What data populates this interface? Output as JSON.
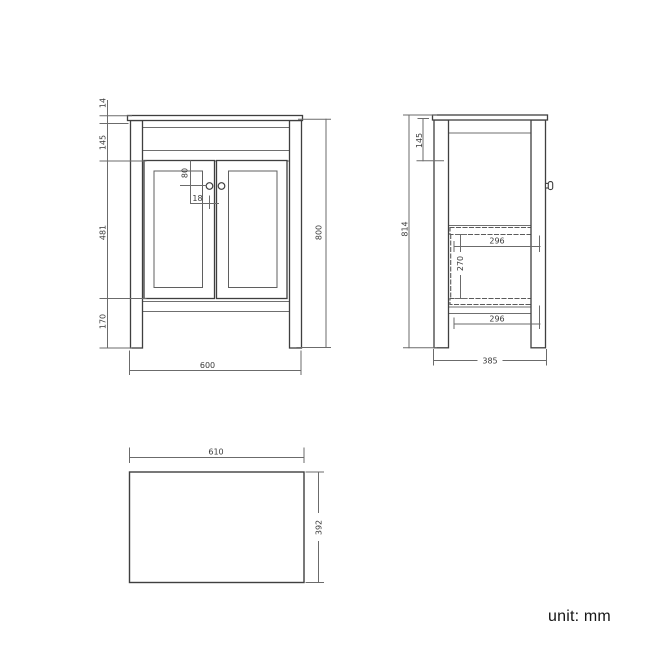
{
  "front": {
    "thickness": "14",
    "top_height": "145",
    "handle_v": "80",
    "handle_h": "18",
    "door_height": "481",
    "leg_height": "170",
    "height": "800",
    "width": "600"
  },
  "side": {
    "top_height": "145",
    "height": "814",
    "shelf_top_width": "296",
    "shelf_gap": "270",
    "shelf_bottom_width": "296",
    "depth": "385"
  },
  "top": {
    "width": "610",
    "depth": "392"
  },
  "unit_label": "unit: mm",
  "colors": {
    "outline": "#3f3f3f",
    "inner_line": "#6f6f6f",
    "dimension_line": "#6b6b6b",
    "hidden_line": "#5a5a5a",
    "text": "#3a3a3a",
    "background": "#ffffff"
  }
}
